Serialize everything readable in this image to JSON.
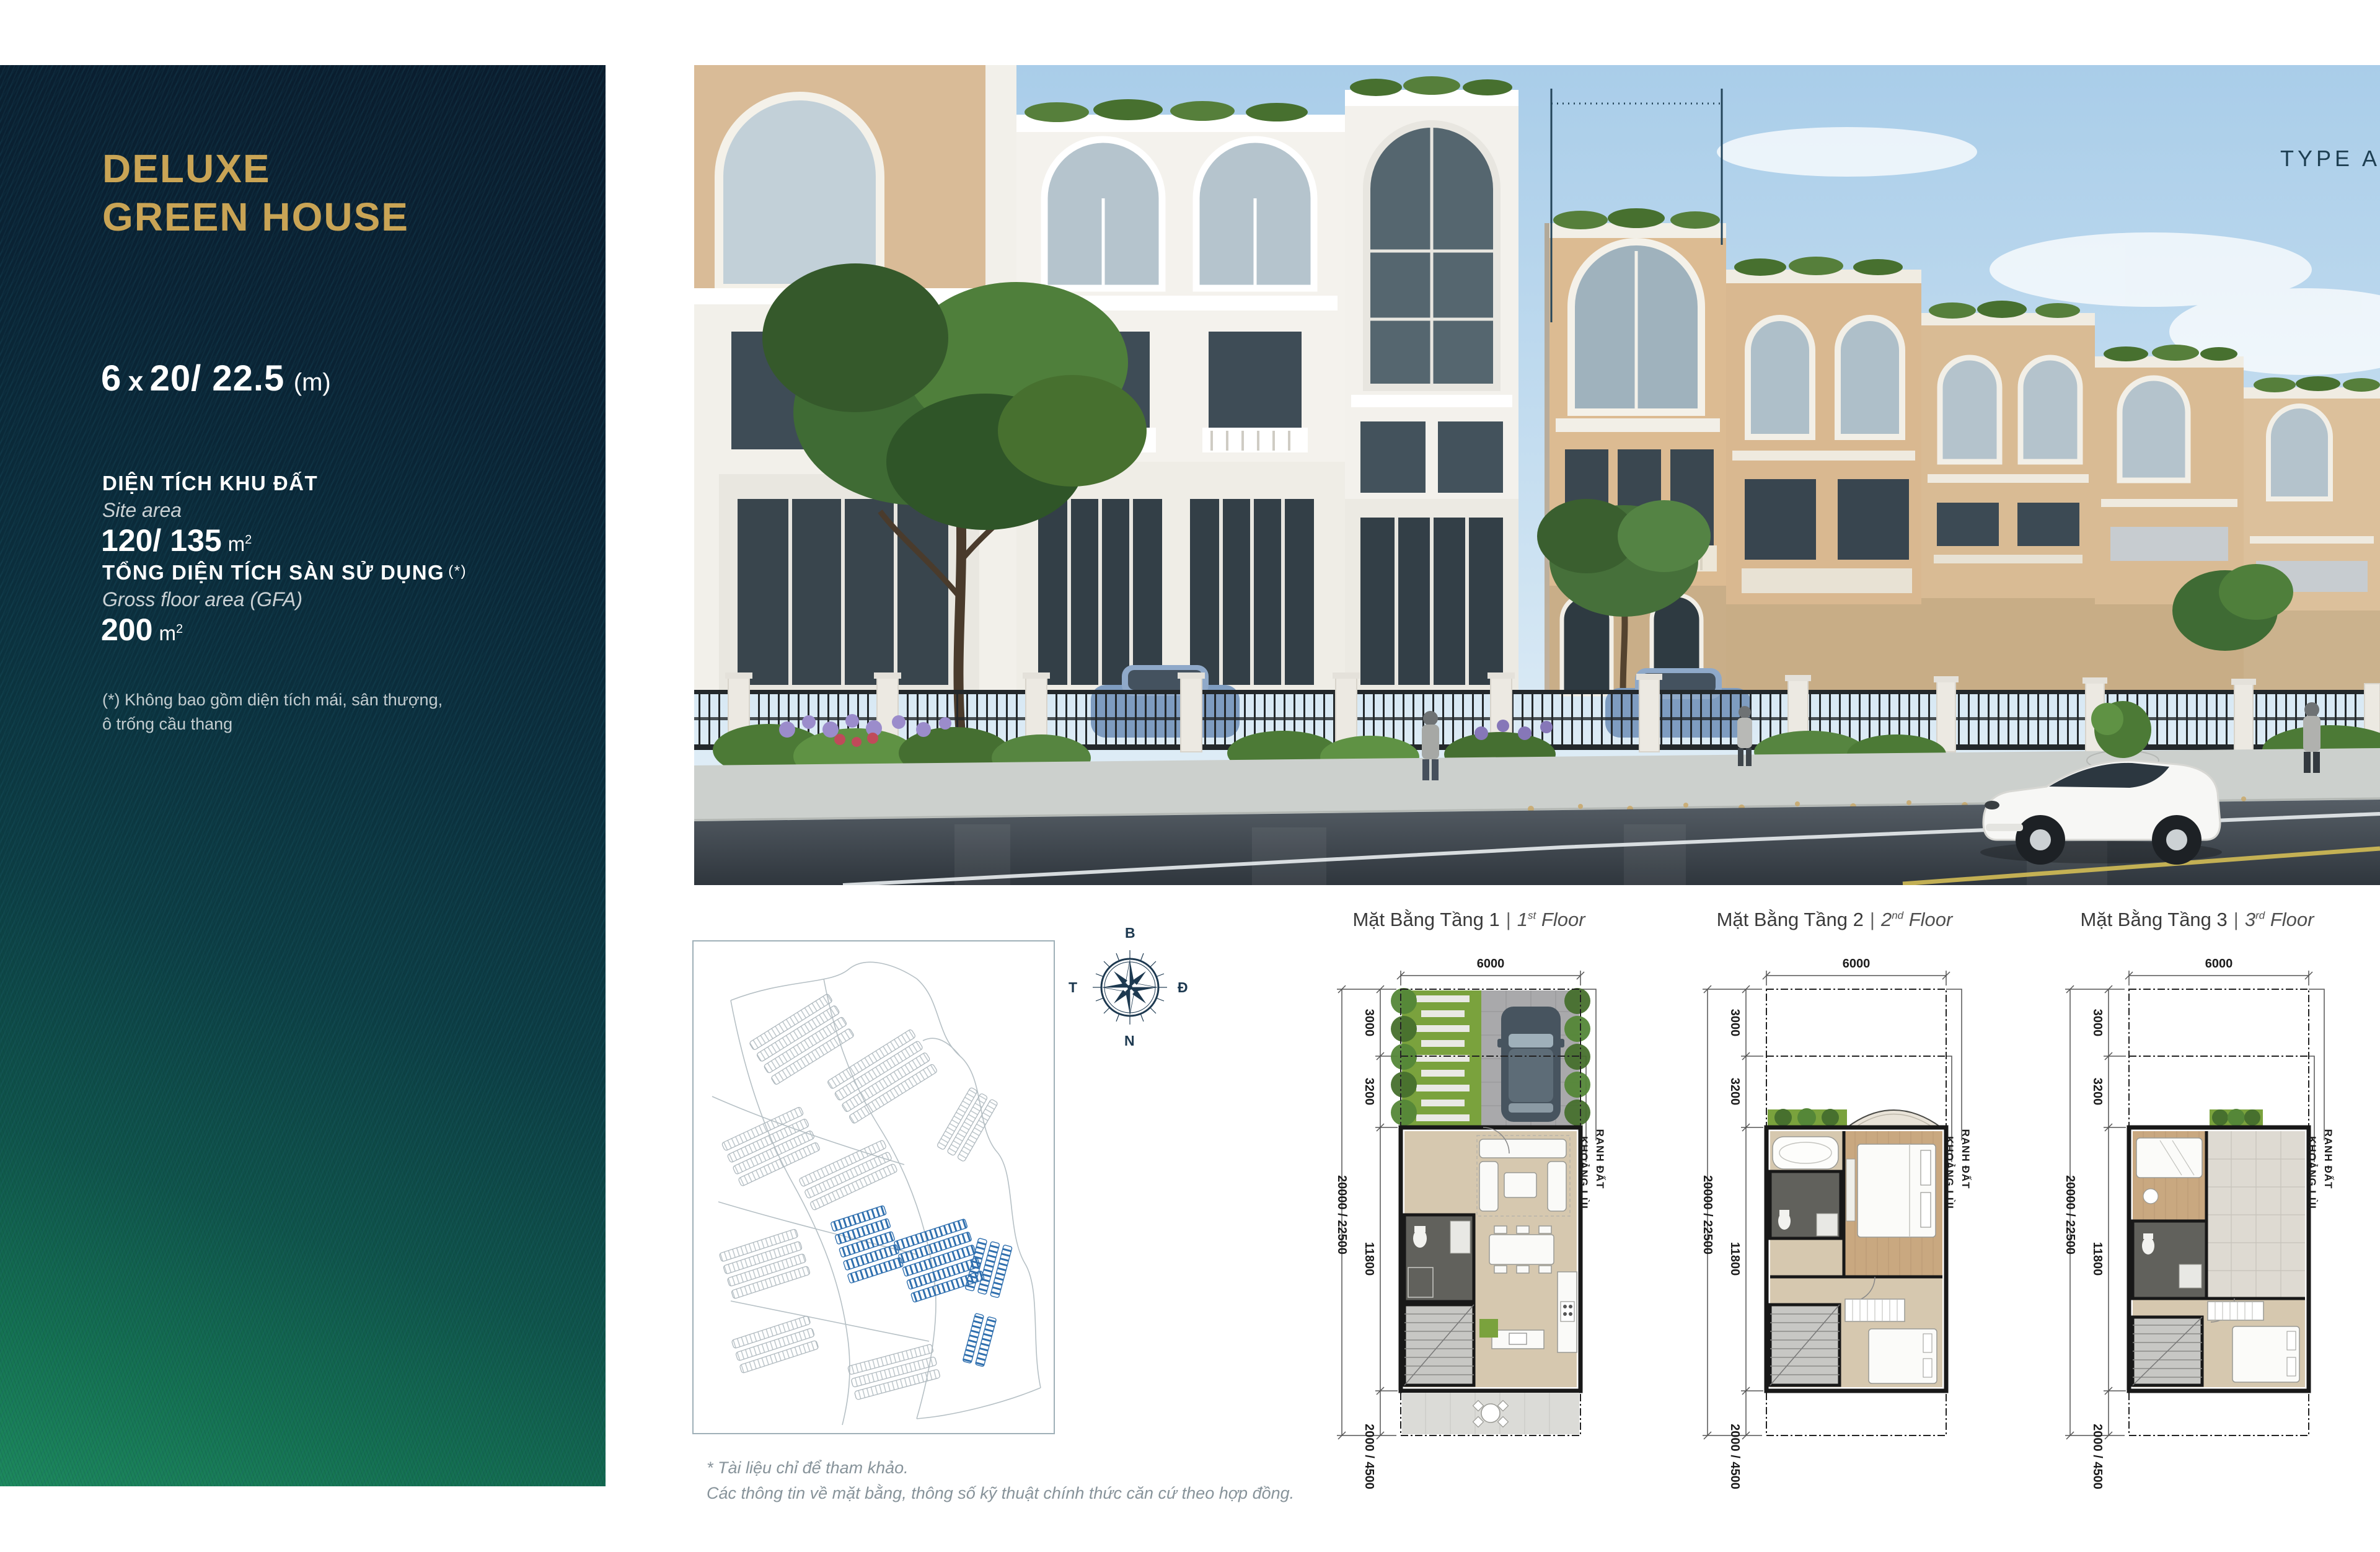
{
  "sidebar": {
    "title_line1": "DELUXE",
    "title_line2": "GREEN HOUSE",
    "dimensions": {
      "value": "6",
      "times": "x",
      "rest": "20/ 22.5",
      "unit": "(m)"
    },
    "site_area": {
      "label_vi": "DIỆN TÍCH KHU ĐẤT",
      "label_en": "Site area",
      "value": "120/ 135",
      "unit": "m",
      "sup": "2"
    },
    "gfa": {
      "label_vi": "TỔNG DIỆN TÍCH SÀN SỬ DỤNG",
      "star": "(*)",
      "label_en": "Gross floor area (GFA)",
      "value": "200",
      "unit": "m",
      "sup": "2"
    },
    "footnote_line1": "(*) Không bao gồm diện tích mái, sân thượng,",
    "footnote_line2": "ô trống cầu thang",
    "colors": {
      "gold": "#c9a455",
      "panel_navy": "#0a1b2c",
      "panel_green": "#1d8a5c"
    }
  },
  "render": {
    "type_label": "TYPE A"
  },
  "site_map": {
    "compass": {
      "north": "B",
      "east": "Đ",
      "south": "N",
      "west": "T"
    },
    "highlight_color": "#2f6fae"
  },
  "plans": [
    {
      "title_vi": "Mặt Bằng Tầng 1",
      "sep": "|",
      "ord": "1",
      "sup": "st",
      "floor_word": "Floor"
    },
    {
      "title_vi": "Mặt Bằng Tầng 2",
      "sep": "|",
      "ord": "2",
      "sup": "nd",
      "floor_word": "Floor"
    },
    {
      "title_vi": "Mặt Bằng Tầng 3",
      "sep": "|",
      "ord": "3",
      "sup": "rd",
      "floor_word": "Floor"
    }
  ],
  "plan_dims": {
    "width": "6000",
    "front": "3000",
    "front2": "3200",
    "overall": "20000 / 22500",
    "body": "11800",
    "rear": "2000 / 4500",
    "boundary": "RANH ĐẤT",
    "setback": "KHOẢNG LÙI"
  },
  "footer": {
    "line1": "* Tài liệu chỉ để tham khảo.",
    "line2": "Các thông tin về mặt bằng, thông số kỹ thuật chính thức căn cứ theo hợp đồng."
  }
}
